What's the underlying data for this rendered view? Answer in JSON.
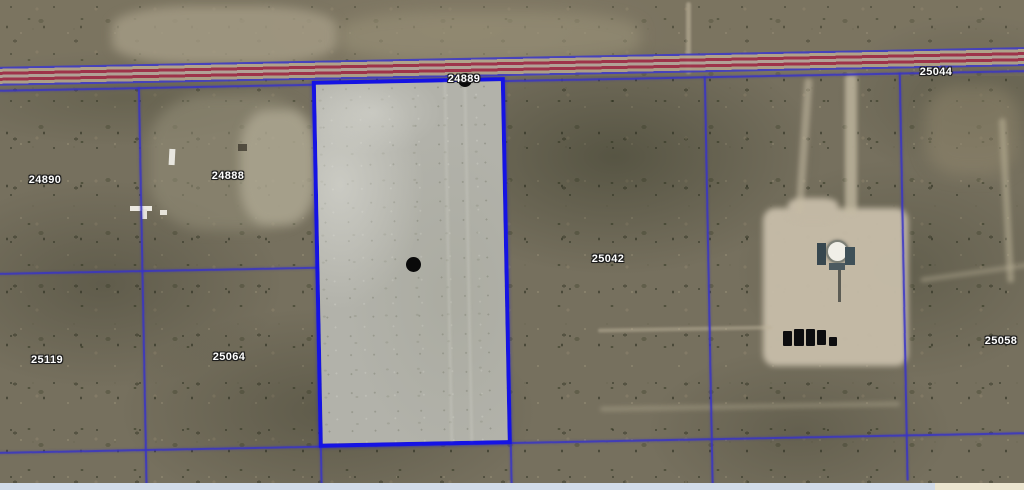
{
  "map": {
    "description": "Aerial satellite view with cadastral parcel boundary overlay",
    "highlighted_parcel": {
      "id": "24889",
      "border_color": "#1513e4",
      "fill_color": "#b2b2aa",
      "marker": "black-dot"
    },
    "labels": [
      {
        "id": "24889"
      },
      {
        "id": "24890"
      },
      {
        "id": "24888"
      },
      {
        "id": "25044"
      },
      {
        "id": "25042"
      },
      {
        "id": "25058"
      },
      {
        "id": "25119"
      },
      {
        "id": "25064"
      }
    ],
    "road": {
      "type": "highway",
      "stripe_color": "#a03049",
      "edge_line_color": "#433fc0"
    },
    "boundary_line_color": "#3834c6",
    "label_text_color": "#ffffff",
    "bottom_strip_colors": [
      "#d2dce9",
      "#ece5d0"
    ]
  }
}
